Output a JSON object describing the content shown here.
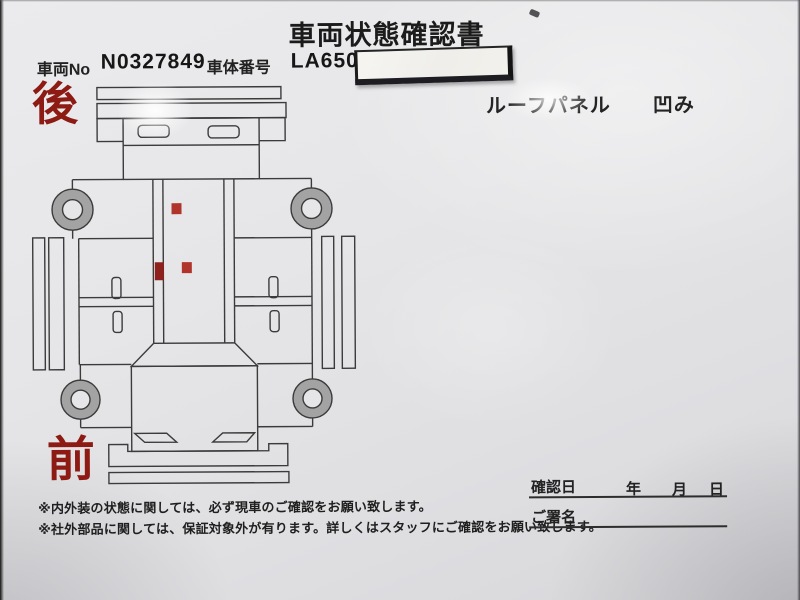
{
  "document": {
    "title": "車両状態確認書",
    "fields": {
      "vehicle_no_label": "車両No",
      "vehicle_no_value": "N0327849",
      "body_no_label": "車体番号",
      "body_no_value": "LA650S"
    },
    "damage_note": {
      "part": "ルーフパネル",
      "type": "凹み"
    },
    "orientation": {
      "rear": "後",
      "front": "前"
    },
    "notes": [
      "※内外装の状態に関しては、必ず現車のご確認をお願い致します。",
      "※社外部品に関しては、保証対象外が有ります。詳しくはスタッフにご確認をお願い致します。"
    ],
    "confirmation": {
      "date_label": "確認日",
      "year_label": "年",
      "month_label": "月",
      "day_label": "日",
      "signature_label": "ご署名"
    }
  },
  "diagram": {
    "damage_markers": [
      {
        "x": 152,
        "y": 122,
        "w": 10,
        "h": 11,
        "color": "#b0342b"
      },
      {
        "x": 135,
        "y": 181,
        "w": 9,
        "h": 18,
        "color": "#8e211b"
      },
      {
        "x": 162,
        "y": 181,
        "w": 10,
        "h": 11,
        "color": "#b0342b"
      }
    ]
  },
  "colors": {
    "accent_red": "#8d1a13",
    "marker_red": "#b0342b",
    "line_gray": "#3b3b3b",
    "wheel_gray": "#a3a3a3",
    "paper": "#e6e6e8",
    "sticker_white": "#f4f3ef"
  }
}
